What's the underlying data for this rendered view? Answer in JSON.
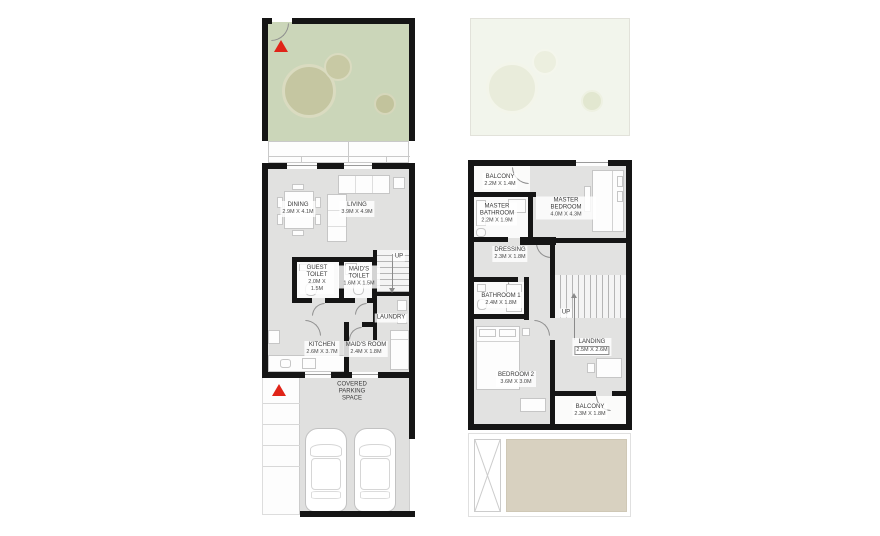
{
  "colors": {
    "wall": "#151515",
    "interior_floor": "#e1e1e0",
    "garden_green": "#cbd6b9",
    "garden_faded": "#f2f5ec",
    "tree_fill": "#c5c6a1",
    "sand_terrace": "#d8d1c0",
    "entry_marker_red": "#e02418"
  },
  "plans": {
    "ground": {
      "rooms": {
        "dining": {
          "name": "DINING",
          "dims": "2.9M X 4.1M"
        },
        "living": {
          "name": "LIVING",
          "dims": "3.9M X 4.9M"
        },
        "guest_toilet": {
          "name": "GUEST TOILET",
          "dims": "2.0M X 1.5M"
        },
        "maids_toilet": {
          "name": "MAID'S TOILET",
          "dims": "1.6M X 1.5M"
        },
        "laundry": {
          "name": "LAUNDRY"
        },
        "kitchen": {
          "name": "KITCHEN",
          "dims": "2.6M X 3.7M"
        },
        "maids_room": {
          "name": "MAID'S ROOM",
          "dims": "2.4M X 1.8M"
        },
        "parking": {
          "name": "COVERED PARKING SPACE"
        }
      },
      "stairs": {
        "label": "UP"
      }
    },
    "first": {
      "rooms": {
        "balcony_top": {
          "name": "BALCONY",
          "dims": "2.2M X 1.4M"
        },
        "master_bathroom": {
          "name": "MASTER BATHROOM",
          "dims": "2.2M X 1.9M"
        },
        "master_bedroom": {
          "name": "MASTER BEDROOM",
          "dims": "4.0M X 4.3M"
        },
        "dressing": {
          "name": "DRESSING",
          "dims": "2.3M X 1.8M"
        },
        "bathroom_1": {
          "name": "BATHROOM 1",
          "dims": "2.4M X 1.8M"
        },
        "landing": {
          "name": "LANDING",
          "dims": "2.5M X 2.6M"
        },
        "bedroom_2": {
          "name": "BEDROOM 2",
          "dims": "3.6M X 3.0M"
        },
        "balcony_bottom": {
          "name": "BALCONY",
          "dims": "2.3M X 1.8M"
        }
      },
      "stairs": {
        "label": "UP"
      }
    }
  }
}
